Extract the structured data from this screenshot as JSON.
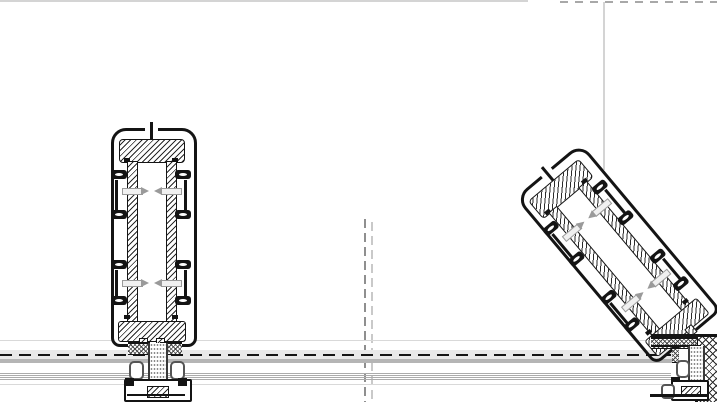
{
  "document": {
    "kind": "cad-section-detail",
    "description": "Technical cross-section detail: aluminium cover-cap glazing profile shown in closed (vertical) position and tilted position on its base hinge, mounted over continuous horizontal frame rails with dashed centerlines and grey reference axes.",
    "visible_text": []
  },
  "geometry": {
    "tilt_angle_deg": -40,
    "tilted_profile_transform": "rotate(-40deg)"
  },
  "colors": {
    "ink": "#141414",
    "hatch_line": "#2a2a2a",
    "ref_line": "#d4d4d4",
    "top_dash": "#a8a8a8",
    "axis_dark": "#8f8f8f",
    "axis_light": "#c9c9c9",
    "rail_light": "#e9e9e9",
    "rail_mid": "#b5b5b5",
    "rail_thin": "#ababab",
    "rail_faint": "#d9d9d9",
    "centerline": "#151515",
    "screw_gray": "#9a9a9a",
    "gasket_gray": "#555555"
  },
  "components": [
    "cover-cap-profile-closed",
    "cover-cap-profile-tilted",
    "insulator-blocks",
    "glazing-clips",
    "fixing-screws",
    "base-rails",
    "hinge-base-brackets",
    "corner-post-lattice",
    "reference-axes"
  ]
}
